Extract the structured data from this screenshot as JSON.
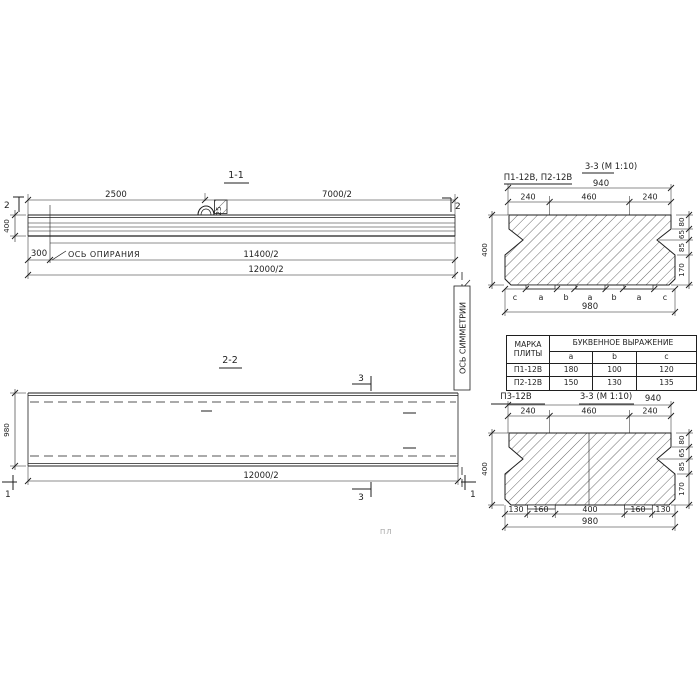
{
  "drawing": {
    "section_1_1": {
      "title": "1-1",
      "marker_left": "2",
      "marker_right": "2",
      "dim_2500": "2500",
      "dim_7000": "7000/2",
      "dim_300": "300",
      "dim_400": "400",
      "dim_11400": "11400/2",
      "dim_12000": "12000/2",
      "support_axis_label": "ОСЬ ОПИРАНИЯ",
      "loop_plate_label": "25"
    },
    "section_2_2": {
      "title": "2-2",
      "marker_3_top": "3",
      "marker_3_bottom": "3",
      "marker_1_left": "1",
      "marker_1_right": "1",
      "dim_980": "980",
      "dim_12000": "12000/2",
      "symmetry_axis_label": "ОСЬ СИММЕТРИИ"
    },
    "cross_section_top": {
      "label": "П1-12В, П2-12В",
      "title": "3-3 (М 1:10)",
      "dim_top_total": "940",
      "dim_top_parts": [
        "240",
        "460",
        "240"
      ],
      "dim_height": "400",
      "dim_right_parts": [
        "80",
        "65",
        "85",
        "170"
      ],
      "letters": [
        "c",
        "a",
        "b",
        "a",
        "b",
        "a",
        "c"
      ],
      "dim_bottom_total": "980"
    },
    "table": {
      "col_mark_line1": "МАРКА",
      "col_mark_line2": "ПЛИТЫ",
      "header_span": "БУКВЕННОЕ ВЫРАЖЕНИЕ",
      "col_a": "a",
      "col_b": "b",
      "col_c": "c",
      "rows": [
        {
          "mark": "П1-12В",
          "a": "180",
          "b": "100",
          "c": "120"
        },
        {
          "mark": "П2-12В",
          "a": "150",
          "b": "130",
          "c": "135"
        }
      ]
    },
    "cross_section_bottom": {
      "label": "П3-12В",
      "title": "3-3 (М 1:10)",
      "dim_top_total": "940",
      "dim_top_parts": [
        "240",
        "460",
        "240"
      ],
      "dim_height": "400",
      "dim_right_parts": [
        "80",
        "65",
        "85",
        "170"
      ],
      "dim_bottom_parts": [
        "130",
        "160",
        "400",
        "160",
        "130"
      ],
      "dim_bottom_total": "980"
    },
    "artifact_text": "ПЛ"
  },
  "colors": {
    "ink": "#1f1f1f",
    "paper": "#ffffff",
    "faint": "#a5a5a5"
  }
}
